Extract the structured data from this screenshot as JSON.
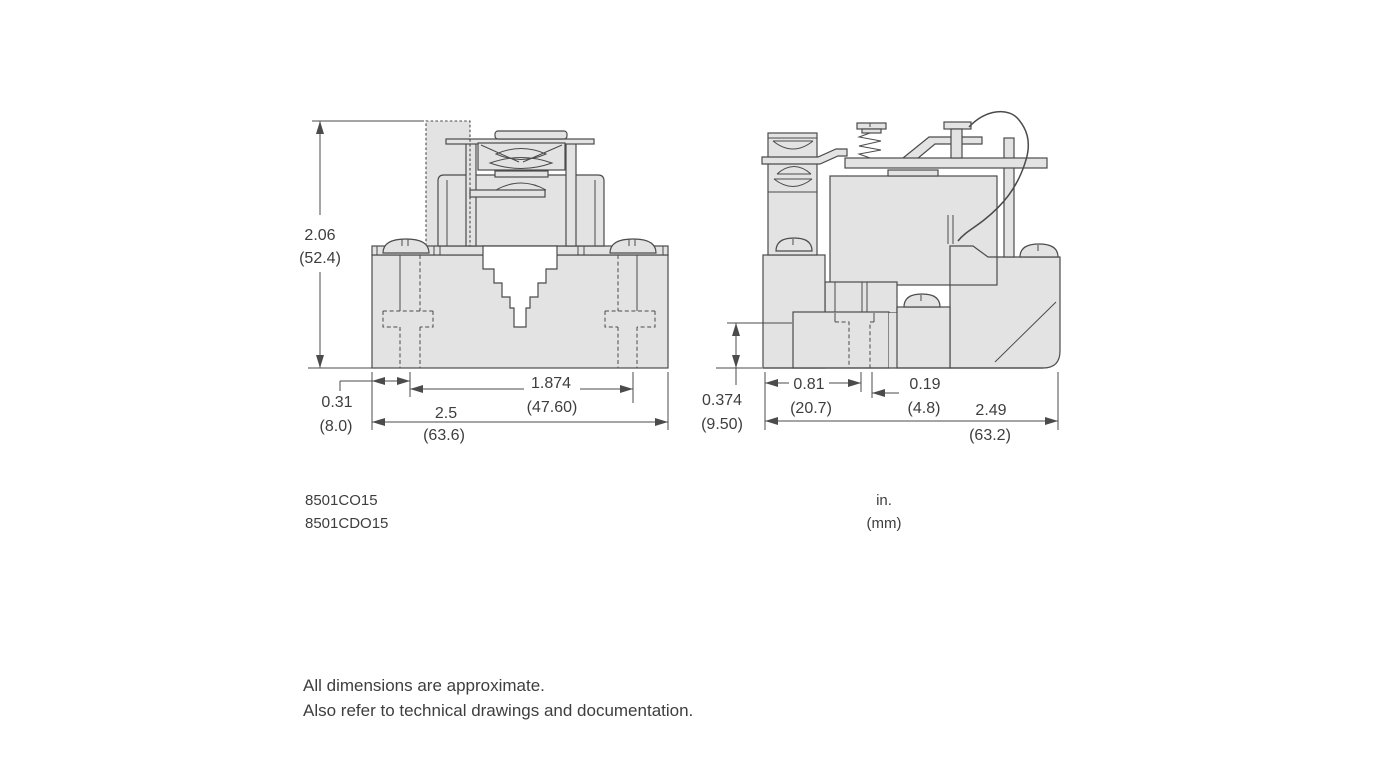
{
  "drawing": {
    "colors": {
      "line": "#4b4b4b",
      "fill": "#e3e3e3",
      "text": "#3e3e3e",
      "background": "#ffffff"
    },
    "left_view": {
      "height_in": "2.06",
      "height_mm": "(52.4)",
      "offset_in": "0.31",
      "offset_mm": "(8.0)",
      "slot_spacing_in": "1.874",
      "slot_spacing_mm": "(47.60)",
      "width_in": "2.5",
      "width_mm": "(63.6)"
    },
    "right_view": {
      "slot_height_in": "0.374",
      "slot_height_mm": "(9.50)",
      "slot_offset_in": "0.81",
      "slot_offset_mm": "(20.7)",
      "slot_width_in": "0.19",
      "slot_width_mm": "(4.8)",
      "depth_in": "2.49",
      "depth_mm": "(63.2)"
    },
    "model_numbers": [
      "8501CO15",
      "8501CDO15"
    ],
    "units": {
      "line1": "in.",
      "line2": "(mm)"
    },
    "footnotes": [
      "All dimensions are approximate.",
      "Also refer to technical drawings and documentation."
    ]
  }
}
